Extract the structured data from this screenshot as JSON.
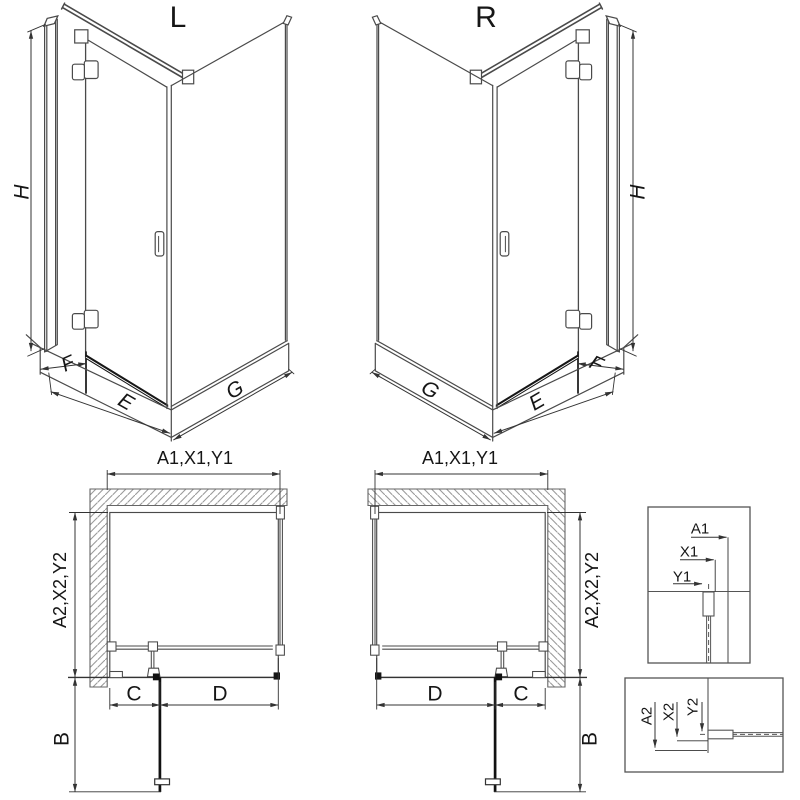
{
  "document": {
    "type": "shower-enclosure technical drawing",
    "colors": {
      "background": "#ffffff",
      "line": "#4a4a4a",
      "dark_line": "#161616",
      "hatch": "#9a9a9a",
      "text": "#161616"
    }
  },
  "labels": {
    "iso_l": {
      "variant": "L",
      "h": "H",
      "f": "F",
      "e": "E",
      "g": "G"
    },
    "iso_r": {
      "variant": "R",
      "h": "H",
      "f": "F",
      "e": "E",
      "g": "G"
    },
    "plan_l": {
      "width": "A1,X1,Y1",
      "depth": "A2,X2,Y2",
      "c": "C",
      "d": "D",
      "b": "B"
    },
    "plan_r": {
      "width": "A1,X1,Y1",
      "depth": "A2,X2,Y2",
      "c": "C",
      "d": "D",
      "b": "B"
    },
    "detail_top": {
      "a1": "A1",
      "x1": "X1",
      "y1": "Y1"
    },
    "detail_bottom": {
      "a2": "A2",
      "x2": "X2",
      "y2": "Y2"
    }
  }
}
